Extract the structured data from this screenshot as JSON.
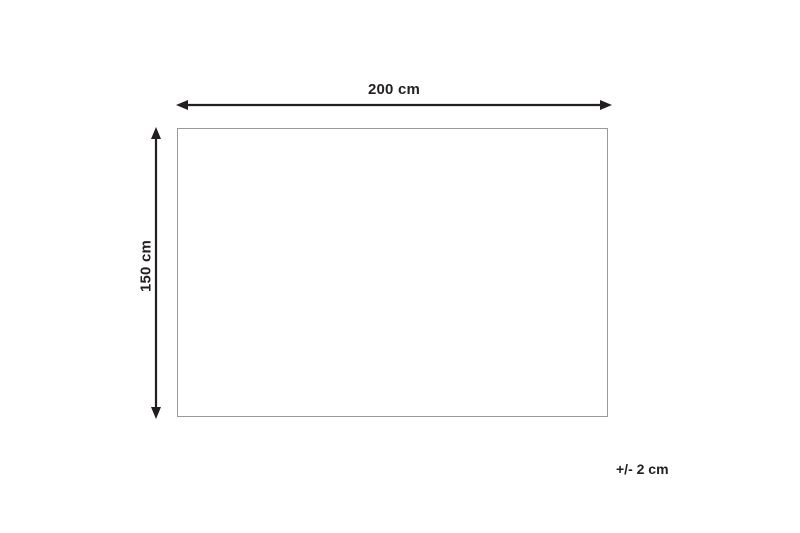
{
  "diagram": {
    "type": "product-dimension-diagram",
    "shape": "rectangle",
    "width_label": "200 cm",
    "height_label": "150 cm",
    "tolerance_label": "+/- 2 cm",
    "width_value_cm": 200,
    "height_value_cm": 150,
    "tolerance_value_cm": 2,
    "colors": {
      "arrow": "#231f20",
      "text": "#231f20",
      "rect_border": "#999999",
      "background": "#ffffff"
    }
  }
}
